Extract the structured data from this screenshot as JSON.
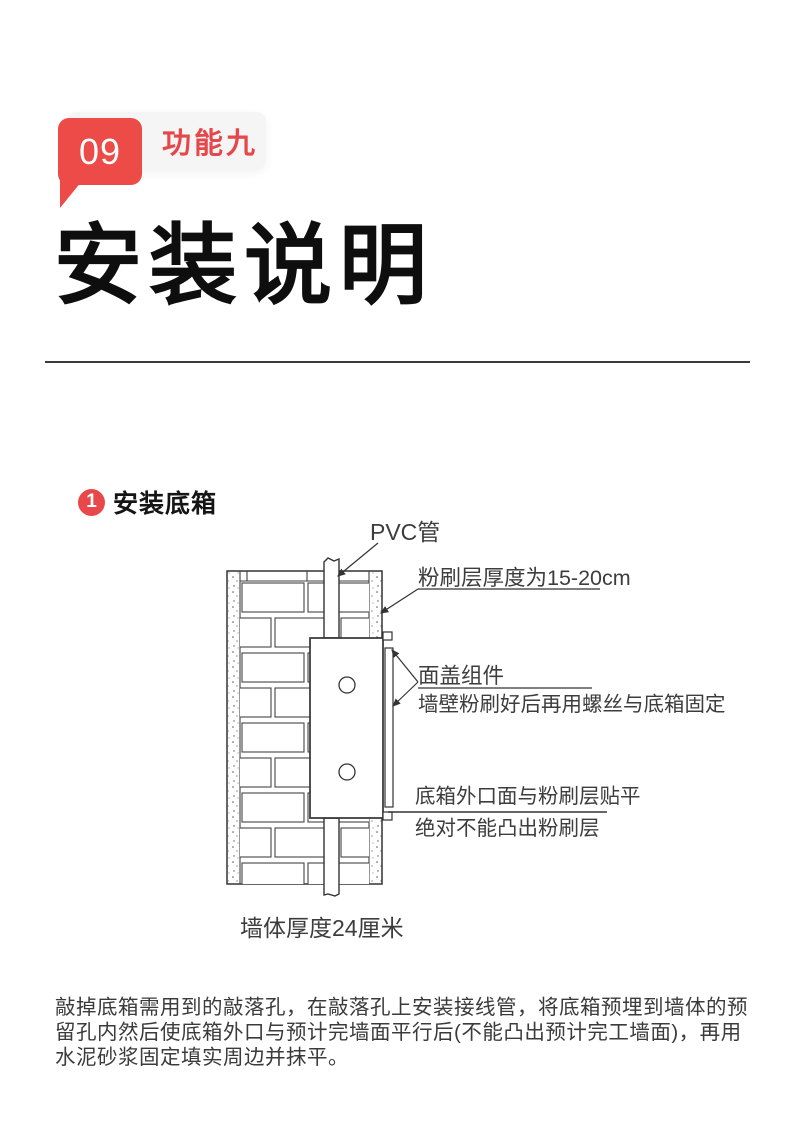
{
  "page": {
    "accent_red": "#e9484b",
    "background": "#ffffff"
  },
  "header": {
    "badge_number": "09",
    "badge_label": "功能九",
    "title": "安装说明"
  },
  "step": {
    "number": "1",
    "title": "安装底箱"
  },
  "diagram": {
    "labels": {
      "pvc": "PVC管",
      "plaster_thickness": "粉刷层厚度为15-20cm",
      "cover_assembly": "面盖组件",
      "cover_assembly_note": "墙壁粉刷好后再用螺丝与底箱固定",
      "flush": "底箱外口面与粉刷层贴平",
      "flush_note": "绝对不能凸出粉刷层",
      "wall_caption": "墙体厚度24厘米"
    }
  },
  "body": {
    "lines": [
      "敲掉底箱需用到的敲落孔，在敲落孔上安装接线管，将底箱预埋到墙体的预",
      "留孔内然后使底箱外口与预计完墙面平行后(不能凸出预计完工墙面)，再用",
      "水泥砂浆固定填实周边并抹平。"
    ]
  }
}
